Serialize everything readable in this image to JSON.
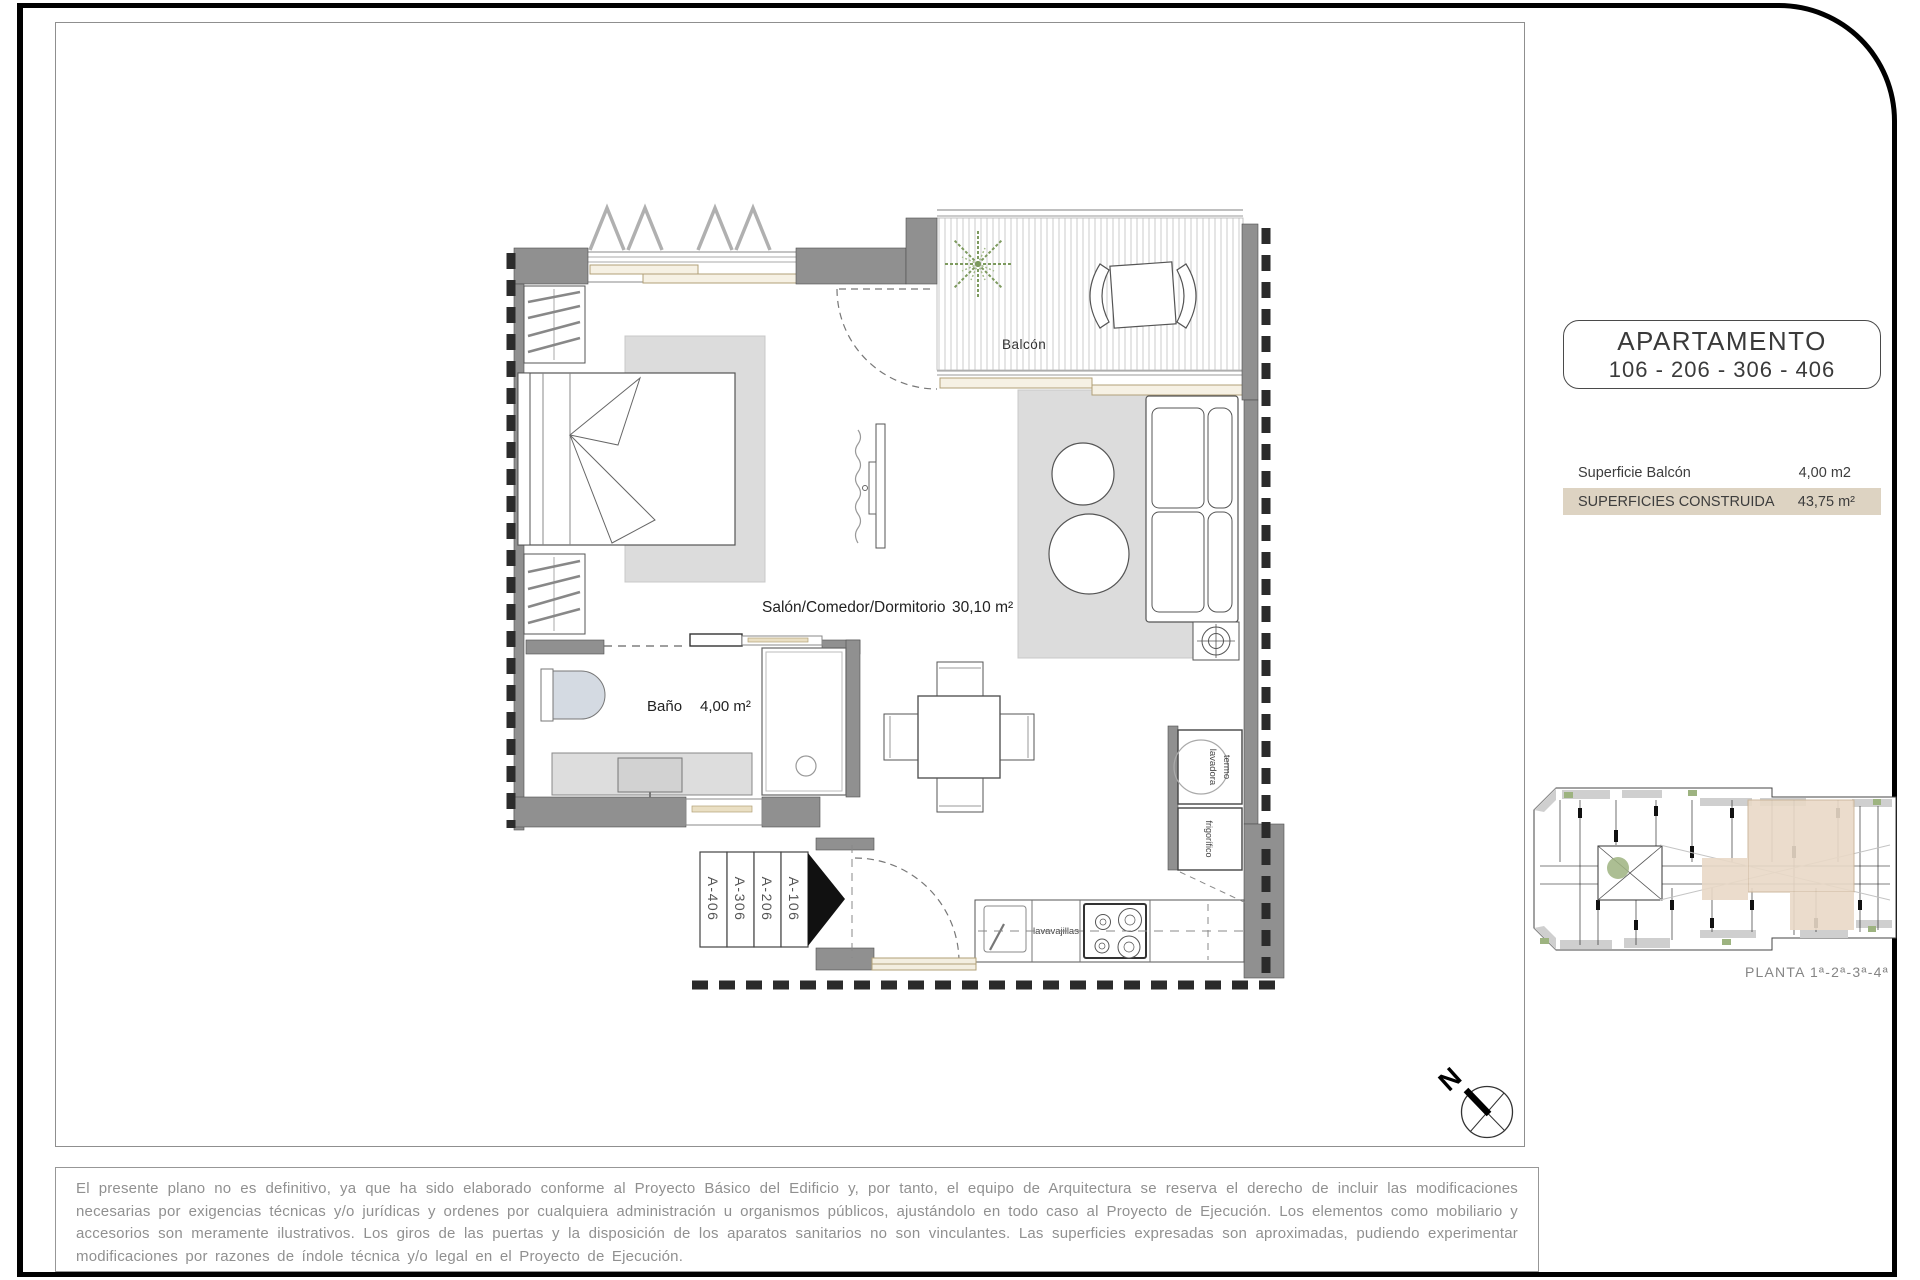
{
  "title_box": {
    "line1": "APARTAMENTO",
    "line2": "106 - 206 - 306 - 406"
  },
  "area_table": {
    "rows": [
      {
        "label": "Superficie Balcón",
        "value": "4,00 m2"
      },
      {
        "label": "SUPERFICIES CONSTRUIDA",
        "value": "43,75 m²"
      }
    ]
  },
  "plan": {
    "balcony_label": "Balcón",
    "living_label": "Salón/Comedor/Dormitorio",
    "living_area": "30,10 m²",
    "bath_label": "Baño",
    "bath_area": "4,00 m²",
    "unit_tags": [
      "A-406",
      "A-306",
      "A-206",
      "A-106"
    ],
    "appliances": {
      "dishwasher": "lavavajillas",
      "boiler": "termo",
      "washer": "lavadora",
      "fridge": "frigorífico"
    }
  },
  "key_plan": {
    "caption": "PLANTA 1ª-2ª-3ª-4ª"
  },
  "compass": {
    "north": "N"
  },
  "disclaimer": {
    "text": "El presente plano no es definitivo, ya que ha sido elaborado conforme al Proyecto Básico del Edificio y, por tanto, el equipo de Arquitectura se reserva el derecho de incluir las modificaciones necesarias por exigencias técnicas y/o jurídicas y ordenes por cualquiera administración u organismos públicos, ajustándolo en todo caso al Proyecto de Ejecución. Los elementos como mobiliario y accesorios son meramente ilustrativos. Los giros de las puertas y la disposición de los aparatos sanitarios no son vinculantes. Las superficies expresadas son aproximadas, pudiendo experimentar modificaciones por razones de índole técnica y/o legal en el Proyecto de Ejecución."
  },
  "colors": {
    "wall_gray": "#909090",
    "rug_gray": "#dcdcdc",
    "highlight_row": "#ddd3c2",
    "key_plan_highlight": "#e9d9c7",
    "frame_tan": "#b1a077",
    "plant_green": "#7d9a5e",
    "text_dark": "#3a3a3a",
    "text_gray": "#909090"
  }
}
